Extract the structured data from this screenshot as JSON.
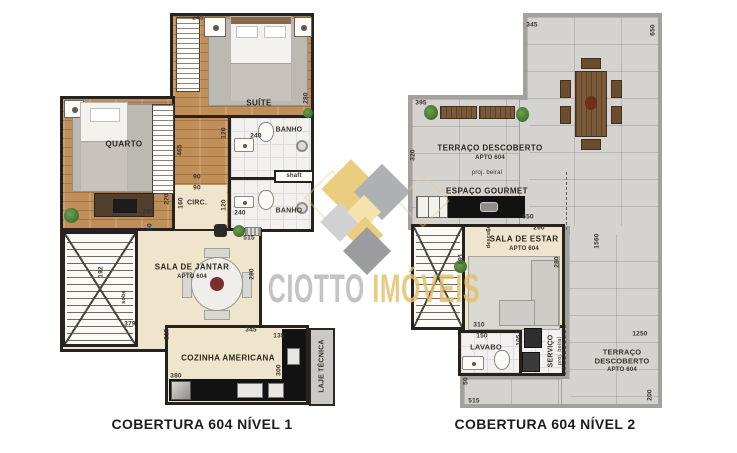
{
  "watermark": {
    "first": "CIOTTO",
    "second": "IMÓVEIS",
    "colors": {
      "gray": "#b5b7ba",
      "gold": "#e3bf66"
    }
  },
  "captions": {
    "level1": "COBERTURA 604 NÍVEL 1",
    "level2": "COBERTURA 604 NÍVEL 2"
  },
  "level1": {
    "rooms": {
      "suite": "SUÍTE",
      "quarto": "QUARTO",
      "banho1": "BANHO",
      "banho2": "BANHO",
      "circ": "CIRC.",
      "shaft": "shaft",
      "jantar": "SALA DE JANTAR",
      "jantar_sub": "APTO 604",
      "cozinha": "COZINHA AMERICANA",
      "laje": "LAJE TÉCNICA",
      "sobe": "sobe"
    },
    "dims": {
      "suite_top": "245",
      "suite_right": "280",
      "banho1_w": "240",
      "banho1_h": "120",
      "banho2_w": "240",
      "banho2_h": "120",
      "closet_h": "465",
      "circ_w1": "90",
      "circ_w2": "90",
      "circ_h": "160",
      "quarto_w": "290",
      "quarto_h": "220",
      "hall": "515",
      "stairs_h": "192",
      "jantar_top": "60",
      "jantar_w": "379",
      "jantar_side": "215",
      "jantar_right": "280",
      "cozinha_top": "345",
      "cozinha_right_top": "135",
      "cozinha_bottom": "380",
      "cozinha_right": "300"
    }
  },
  "level2": {
    "rooms": {
      "terraco1": "TERRAÇO DESCOBERTO",
      "terraco1_sub": "APTO 604",
      "proj1": "proj. beiral",
      "gourmet": "ESPAÇO GOURMET",
      "sala": "SALA DE ESTAR",
      "sala_sub": "APTO 604",
      "lavabo": "LAVABO",
      "servico": "SERVIÇO",
      "proj2": "proj. beiral",
      "terraco2_l1": "TERRAÇO",
      "terraco2_l2": "DESCOBERTO",
      "terraco2_sub": "APTO 604",
      "desce": "desce"
    },
    "dims": {
      "top": "345",
      "top_right": "650",
      "left_top": "395",
      "left": "320",
      "gourmet_w": "650",
      "sala_top": "260",
      "sala_right": "280",
      "stairs_w": "191",
      "stairs_top": "60",
      "sala_bottom": "310",
      "lavabo_w": "150",
      "lavabo_h": "105",
      "right": "1560",
      "terraco2_top": "1250",
      "terraco2_right": "200",
      "bottom": "515",
      "bottom_left": "50"
    }
  }
}
